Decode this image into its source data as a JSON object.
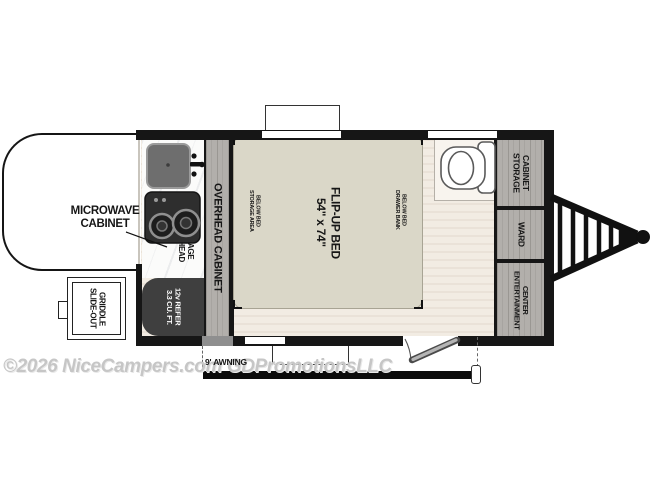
{
  "watermark": "©2026 NiceCampers.com GDPromotionsLLC",
  "colors": {
    "wall": "#161616",
    "floor": "#f2ece3",
    "bed": "#dad7c8",
    "cabinet_wood": "#b2afab",
    "refrigerator": "#3f3f3f",
    "counter": "#fbfbfa"
  },
  "rooms": {
    "kitchen": {
      "microwave_cabinet": "MICROWAVE\nCABINET",
      "overhead_storage": "OVERHEAD\nSTORAGE",
      "refrigerator": "3.3 CU. FT.\n12v REFER",
      "griddle": "SLIDE-OUT\nGRIDDLE",
      "overhead_cabinet": "OVERHEAD CABINET"
    },
    "bedroom": {
      "bed": "54\" x 74\"\nFLIP-UP BED",
      "storage_below": "STORAGE AREA\nBELOW BED",
      "drawer_bank": "DRAWER BANK\nBELOW BED"
    },
    "rear_wall": {
      "storage_cabinet": "STORAGE\nCABINET",
      "ward": "WARD",
      "entertainment_center": "ENTERTAINMENT\nCENTER"
    },
    "exterior": {
      "awning": "9' AWNING"
    }
  }
}
